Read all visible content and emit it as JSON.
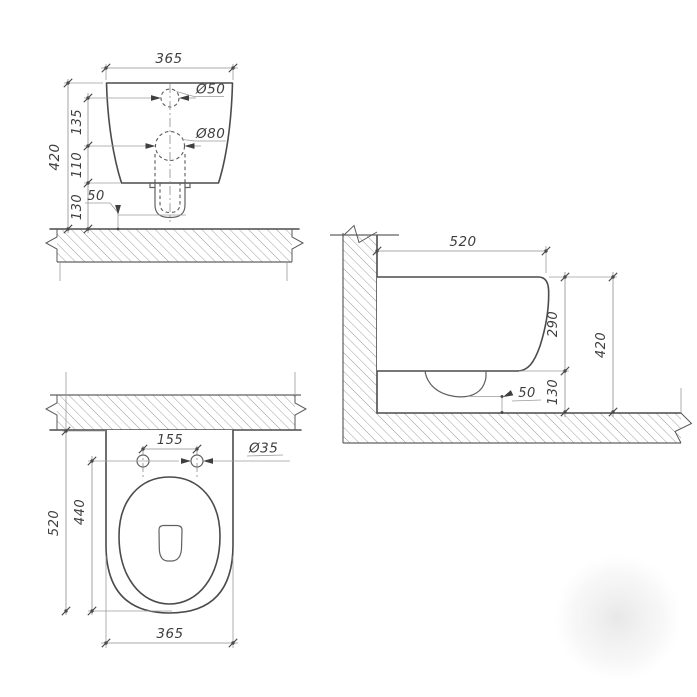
{
  "drawing": {
    "subject": "wall-hung-toilet-dimension-drawing",
    "units": "mm",
    "colors": {
      "line": "#4b4b4b",
      "dimension": "#8c8c8c",
      "hatch": "#8f8f8f",
      "text": "#3e3e3e",
      "shadow": "#c9c9c9"
    }
  },
  "front_view": {
    "dim_width": "365",
    "dim_height_total": "420",
    "dim_hole_spacing_vert": "135",
    "dim_hole_to_body_bottom": "110",
    "dim_body_bottom_to_floor": "130",
    "dim_drain_to_floor": "50",
    "label_hole_small": "Ø50",
    "label_hole_large": "Ø80"
  },
  "side_view": {
    "dim_depth": "520",
    "dim_body_height": "290",
    "dim_height_total": "420",
    "dim_body_bottom_to_floor": "130",
    "dim_drain_to_floor": "50"
  },
  "plan_view": {
    "dim_depth": "520",
    "dim_holes_to_front": "440",
    "dim_hole_spacing": "155",
    "dim_hole_diameter": "Ø35",
    "dim_width": "365"
  }
}
